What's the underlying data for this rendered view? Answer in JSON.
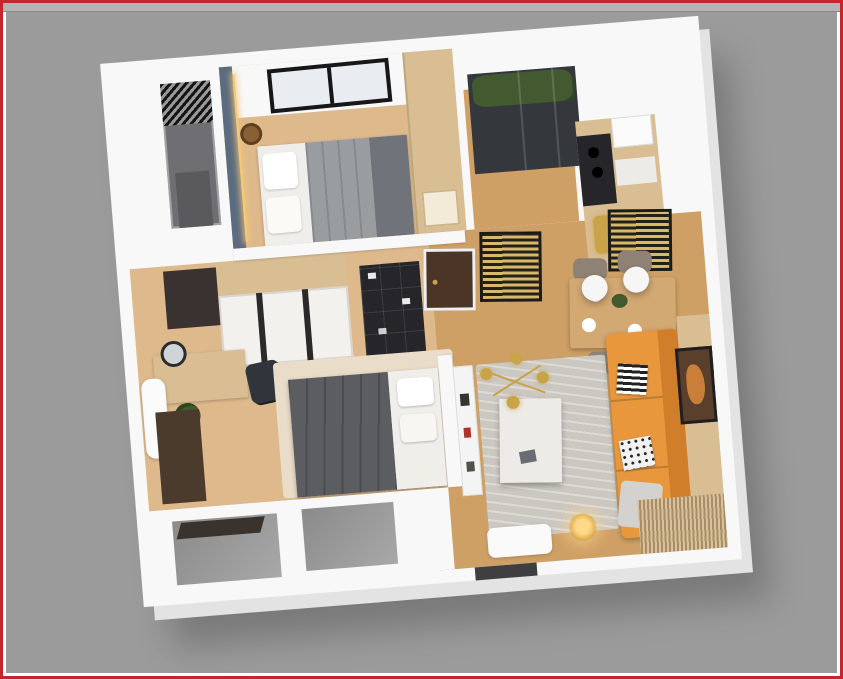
{
  "palette": {
    "frame_red": "#c1272d",
    "frame_white": "#ffffff",
    "bg_gray": "#9b9b9b",
    "bg_band": "#b4b4b4",
    "bg_band_line": "#8a8a8a",
    "wall_white": "#f8f8f8",
    "wall_shade": "#ebebeb",
    "wall_extrude": "#e3e3e3",
    "floor_bedroom": "#deb98c",
    "floor_warm": "#cfa066",
    "accent_blue": "#5c6c80",
    "led_gold": "#f3c878",
    "wood_cabinet": "#d9bd93",
    "door_brown": "#4a3526",
    "fixture_black": "#26262a",
    "glass_dark": "#34383c",
    "plant_green": "#43592f",
    "duvet_gray": "#5c5d61",
    "linen_white": "#f0eeea",
    "blanket_gray": "#9a9da0",
    "bed_foot_gray": "#70737a",
    "rug_gray": "#cbc7c1",
    "rug_cream": "#e9ddc9",
    "marble": "#edebe7",
    "sofa_orange": "#e8973d",
    "sofa_shadow": "#d07e2a",
    "table_wood": "#d2a873",
    "chair_taupe": "#8f8275",
    "brass": "#c9a348",
    "art_brown": "#5a3f2c",
    "art_accent": "#c97f3a",
    "slat_gold": "#d8b96a",
    "slat_tan": "#d8c29c",
    "slat_dark": "#a88d66",
    "loggia_gray": "#6f6f73",
    "recess_gray_dark": "#8b8b8b",
    "recess_gray_light": "#a8a8a8",
    "sill_brown": "#3a332d",
    "mat_dark": "#3f3f41",
    "mirror_dark": "#3a3231",
    "rattan_brown": "#8a5f33"
  },
  "scene": {
    "type": "3d-floorplan-render",
    "label": "3D top-down render of a one-bedroom apartment floor plan on gray background with red page border",
    "rooms": [
      {
        "name": "bedroom-1",
        "items": [
          "double-bed",
          "gray-blanket",
          "white-linen",
          "wardrobe",
          "rattan-pendant-lamp",
          "black-frame-window",
          "blue-accent-wall",
          "led-strip"
        ]
      },
      {
        "name": "loggia",
        "items": [
          "ventilation-grate",
          "concrete-floor"
        ]
      },
      {
        "name": "balcony",
        "items": [
          "plants",
          "dark-sliding-glass-door"
        ]
      },
      {
        "name": "kitchen",
        "items": [
          "wood-cabinets",
          "dark-counter",
          "cooktop",
          "white-counter",
          "brass-appliances"
        ]
      },
      {
        "name": "dining-area",
        "items": [
          "wood-dining-table",
          "four-taupe-chairs",
          "two-white-globe-pendants",
          "tableware",
          "hanging-slat-screen"
        ]
      },
      {
        "name": "living-room",
        "items": [
          "orange-three-seat-sofa",
          "striped-pillow",
          "dotted-pillow",
          "gray-throw",
          "gray-area-rug",
          "white-marble-coffee-table",
          "brass-sputnik-chandelier",
          "wood-slat-tv-wall",
          "framed-artwork",
          "console-shelf",
          "glowing-floor-lamp",
          "white-doormat",
          "slatted-deck"
        ]
      },
      {
        "name": "bedroom-2",
        "items": [
          "double-bed",
          "dark-gray-duvet",
          "white-pillows",
          "cream-rug",
          "sliding-door-wardrobe",
          "black-open-shelf-unit",
          "vanity-desk",
          "round-mirror",
          "black-desk-chair",
          "potted-plant",
          "white-bench",
          "dark-floor-mat",
          "dark-window-panel"
        ]
      },
      {
        "name": "entry",
        "items": [
          "dark-wood-entry-door",
          "gold-slat-screen"
        ]
      },
      {
        "name": "facade",
        "items": [
          "window-recess",
          "window-recess",
          "dark-sill-panel",
          "dark-entry-mat",
          "wall-notch"
        ]
      }
    ]
  }
}
